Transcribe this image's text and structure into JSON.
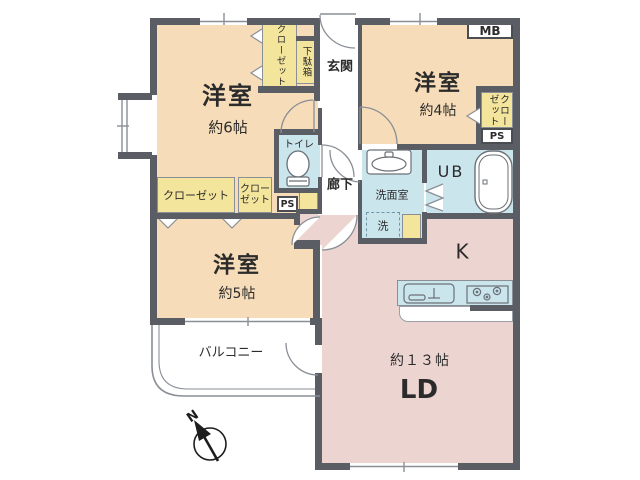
{
  "colors": {
    "wall": "#5a5d63",
    "bedroom_floor": "#f6dcb8",
    "ldk_floor": "#ecd4d1",
    "wet_area_floor": "#cbe5ed",
    "storage_fill": "#f4e59c",
    "outline": "#8a8f96"
  },
  "rooms": {
    "bedroom6": {
      "label": "洋室",
      "size": "約6帖"
    },
    "bedroom4": {
      "label": "洋室",
      "size": "約4帖"
    },
    "bedroom5": {
      "label": "洋室",
      "size": "約5帖"
    },
    "living_dining": {
      "label": "LD",
      "size": "約１３帖"
    },
    "kitchen": {
      "label": "K"
    },
    "unit_bath": {
      "label": "UB"
    },
    "entrance": {
      "label": "玄関"
    },
    "hallway": {
      "label": "廊下"
    },
    "toilet": {
      "label": "トイレ"
    },
    "washroom": {
      "label": "洗面室"
    },
    "balcony": {
      "label": "バルコニー"
    }
  },
  "fixtures": {
    "washing_machine": {
      "label": "洗"
    }
  },
  "storage": {
    "closet_bedroom6": {
      "label": "クローゼット"
    },
    "closet_bedroom5_left": {
      "label": "クローゼット"
    },
    "closet_bedroom5_right": {
      "label": "クロー\nゼット"
    },
    "closet_bedroom4": {
      "label": "クローゼット"
    },
    "shoe_cabinet": {
      "label": "下駄箱"
    }
  },
  "utility": {
    "meter_box": {
      "label": "MB"
    },
    "pipe_space_right": {
      "label": "PS"
    },
    "pipe_space_left": {
      "label": "PS"
    }
  },
  "compass": {
    "north": "N"
  }
}
